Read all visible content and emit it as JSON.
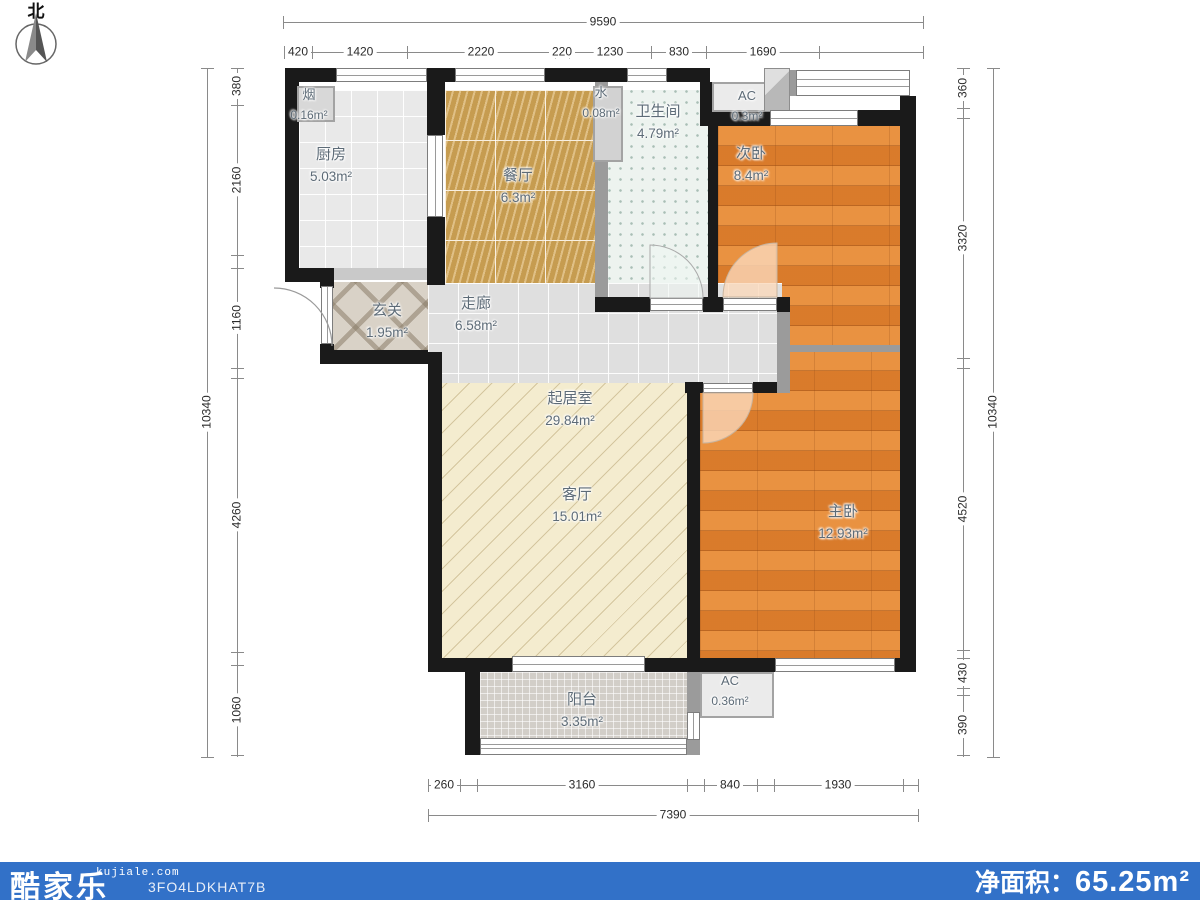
{
  "compass": {
    "label": "北"
  },
  "rooms": {
    "flue": {
      "label": "烟",
      "area": "0.16m²"
    },
    "kitchen": {
      "label": "厨房",
      "area": "5.03m²"
    },
    "dining": {
      "label": "餐厅",
      "area": "6.3m²"
    },
    "water": {
      "label": "水",
      "area": "0.08m²"
    },
    "bath": {
      "label": "卫生间",
      "area": "4.79m²"
    },
    "ac1": {
      "label": "AC",
      "area": "0.3m²"
    },
    "bed2": {
      "label": "次卧",
      "area": "8.4m²"
    },
    "entry": {
      "label": "玄关",
      "area": "1.95m²"
    },
    "corridor": {
      "label": "走廊",
      "area": "6.58m²"
    },
    "living_area": {
      "label": "起居室",
      "area": "29.84m²"
    },
    "living": {
      "label": "客厅",
      "area": "15.01m²"
    },
    "bed1": {
      "label": "主卧",
      "area": "12.93m²"
    },
    "balcony": {
      "label": "阳台",
      "area": "3.35m²"
    },
    "ac2": {
      "label": "AC",
      "area": "0.36m²"
    }
  },
  "dims": {
    "top": {
      "overall": "9590",
      "segments": [
        "420",
        "1420",
        "2220",
        "220",
        "1230",
        "830",
        "1690"
      ]
    },
    "left": {
      "overall": "10340",
      "segments": [
        "380",
        "2160",
        "1160",
        "4260",
        "1060"
      ]
    },
    "right": {
      "overall": "10340",
      "segments": [
        "360",
        "3320",
        "4520",
        "430",
        "390"
      ]
    },
    "bottom": {
      "overall": "7390",
      "segments": [
        "260",
        "3160",
        "840",
        "1930"
      ]
    }
  },
  "footer": {
    "logo": "酷家乐",
    "logo_sub": "kujiale.com",
    "code": "3FO4LDKHAT7B",
    "area_label": "净面积：",
    "area_value": "65.25m²"
  },
  "colors": {
    "footer_blue": "#3271c8",
    "wall_black": "#1a1a1a",
    "wood_orange": "#e18330",
    "dining_gold": "#c69c50",
    "living_cream": "#f4eccf"
  }
}
